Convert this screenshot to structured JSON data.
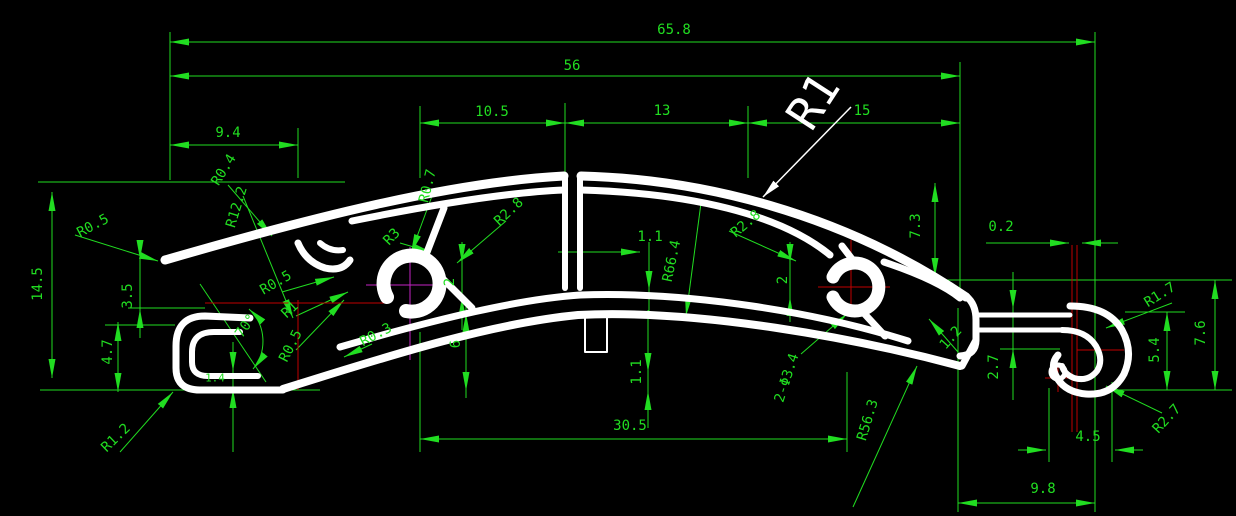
{
  "drawing": {
    "type": "cad-extrusion-profile-cross-section",
    "units_note": "dimension values as shown on screen"
  },
  "colors": {
    "bg": "#000000",
    "dim": "#21dd21",
    "profile": "#ffffff",
    "center_red": "#c00000",
    "center_magenta": "#c324c3"
  },
  "labels": [
    {
      "text": "65.8",
      "x": 674,
      "y": 30,
      "rot": 0
    },
    {
      "text": "56",
      "x": 572,
      "y": 66,
      "rot": 0
    },
    {
      "text": "9.4",
      "x": 228,
      "y": 133,
      "rot": 0
    },
    {
      "text": "10.5",
      "x": 492,
      "y": 112,
      "rot": 0
    },
    {
      "text": "13",
      "x": 662,
      "y": 111,
      "rot": 0
    },
    {
      "text": "15",
      "x": 862,
      "y": 111,
      "rot": 0
    },
    {
      "text": "R1",
      "x": 813,
      "y": 101,
      "rot": -57,
      "size": 46,
      "color": "#ffffff"
    },
    {
      "text": "14.5",
      "x": 38,
      "y": 284,
      "rot": -90
    },
    {
      "text": "R0.5",
      "x": 93,
      "y": 226,
      "rot": -28
    },
    {
      "text": "R0.4",
      "x": 224,
      "y": 170,
      "rot": -58
    },
    {
      "text": "R12.2",
      "x": 237,
      "y": 207,
      "rot": -73
    },
    {
      "text": "3.5",
      "x": 128,
      "y": 296,
      "rot": -90
    },
    {
      "text": "4.7",
      "x": 108,
      "y": 352,
      "rot": -90
    },
    {
      "text": "R1.2",
      "x": 116,
      "y": 438,
      "rot": -44
    },
    {
      "text": "70°",
      "x": 246,
      "y": 326,
      "rot": -55
    },
    {
      "text": "1.4",
      "x": 215,
      "y": 378,
      "rot": 0,
      "size": 11
    },
    {
      "text": "R0.5",
      "x": 276,
      "y": 283,
      "rot": -30
    },
    {
      "text": "R1",
      "x": 290,
      "y": 310,
      "rot": -43
    },
    {
      "text": "R0.5",
      "x": 291,
      "y": 346,
      "rot": -63
    },
    {
      "text": "R0.3",
      "x": 376,
      "y": 335,
      "rot": -28
    },
    {
      "text": "R3",
      "x": 392,
      "y": 237,
      "rot": -46
    },
    {
      "text": "2",
      "x": 450,
      "y": 282,
      "rot": -90
    },
    {
      "text": "6",
      "x": 456,
      "y": 344,
      "rot": -90
    },
    {
      "text": "R0.7",
      "x": 428,
      "y": 186,
      "rot": -76
    },
    {
      "text": "R2.8",
      "x": 509,
      "y": 212,
      "rot": -43
    },
    {
      "text": "1.1",
      "x": 650,
      "y": 237,
      "rot": 0
    },
    {
      "text": "R66.4",
      "x": 672,
      "y": 261,
      "rot": -78
    },
    {
      "text": "R2.8",
      "x": 746,
      "y": 224,
      "rot": -40
    },
    {
      "text": "2",
      "x": 783,
      "y": 280,
      "rot": -90
    },
    {
      "text": "1.1",
      "x": 637,
      "y": 372,
      "rot": -90
    },
    {
      "text": "7.3",
      "x": 916,
      "y": 226,
      "rot": -90
    },
    {
      "text": "0.2",
      "x": 1001,
      "y": 227,
      "rot": 0
    },
    {
      "text": "2-Φ3.4",
      "x": 787,
      "y": 378,
      "rot": -72
    },
    {
      "text": "1.2",
      "x": 951,
      "y": 338,
      "rot": -48
    },
    {
      "text": "2.7",
      "x": 994,
      "y": 367,
      "rot": -90
    },
    {
      "text": "R56.3",
      "x": 868,
      "y": 420,
      "rot": -73
    },
    {
      "text": "30.5",
      "x": 630,
      "y": 426,
      "rot": 0
    },
    {
      "text": "R1.7",
      "x": 1160,
      "y": 295,
      "rot": -32
    },
    {
      "text": "5.4",
      "x": 1155,
      "y": 350,
      "rot": -90
    },
    {
      "text": "7.6",
      "x": 1201,
      "y": 333,
      "rot": -90
    },
    {
      "text": "R2.7",
      "x": 1167,
      "y": 419,
      "rot": -47
    },
    {
      "text": "4.5",
      "x": 1088,
      "y": 437,
      "rot": 0
    },
    {
      "text": "9.8",
      "x": 1043,
      "y": 489,
      "rot": 0
    }
  ]
}
